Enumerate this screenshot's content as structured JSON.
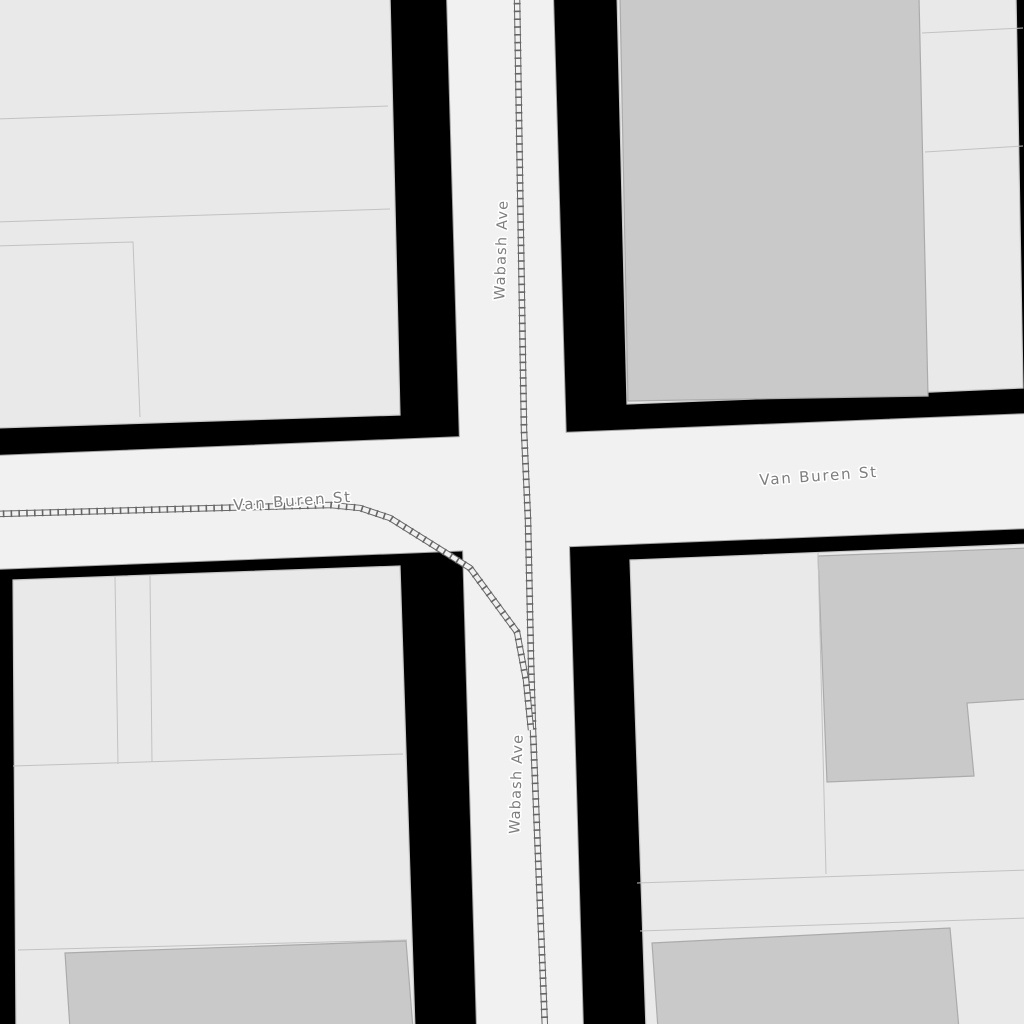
{
  "map": {
    "width": 1024,
    "height": 1024,
    "colors": {
      "background": "#000000",
      "road_fill": "#f1f1f1",
      "road_casing": "#a3a3a3",
      "light_building_fill": "#e9e9e9",
      "light_building_stroke": "#c6c6c6",
      "dark_building_fill": "#c9c9c9",
      "dark_building_stroke": "#ababab",
      "building_line": "#c2c2c2",
      "railway": "#666666",
      "label_fill": "#7e7e7e",
      "label_halo": "#ffffff"
    },
    "roads": [
      {
        "name": "Wabash Ave",
        "points": [
          [
            447,
            -5
          ],
          [
            553,
            -5
          ],
          [
            583,
            1029
          ],
          [
            477,
            1029
          ]
        ]
      },
      {
        "name": "Van Buren St",
        "points": [
          [
            -5,
            456
          ],
          [
            1029,
            414
          ],
          [
            1029,
            528
          ],
          [
            -5,
            569
          ]
        ]
      }
    ],
    "buildings": [
      {
        "shade": "light",
        "block": "northwest",
        "points": [
          [
            -5,
            -5
          ],
          [
            390,
            -5
          ],
          [
            400,
            415
          ],
          [
            -5,
            428
          ]
        ]
      },
      {
        "shade": "light",
        "block": "northeast",
        "points": [
          [
            617,
            -5
          ],
          [
            1016,
            -5
          ],
          [
            1023,
            388
          ],
          [
            932,
            392
          ],
          [
            627,
            404
          ]
        ]
      },
      {
        "shade": "dark",
        "block": "northeast",
        "points": [
          [
            620,
            -3
          ],
          [
            919,
            -3
          ],
          [
            928,
            396
          ],
          [
            628,
            401
          ]
        ]
      },
      {
        "shade": "light",
        "block": "southwest",
        "points": [
          [
            13,
            580
          ],
          [
            400,
            566
          ],
          [
            415,
            1029
          ],
          [
            16,
            1029
          ]
        ]
      },
      {
        "shade": "dark",
        "block": "southwest",
        "points": [
          [
            65,
            953
          ],
          [
            406,
            941
          ],
          [
            413,
            1029
          ],
          [
            70,
            1029
          ]
        ]
      },
      {
        "shade": "light",
        "block": "southeast",
        "points": [
          [
            630,
            560
          ],
          [
            1029,
            544
          ],
          [
            1029,
            1029
          ],
          [
            646,
            1029
          ]
        ]
      },
      {
        "shade": "dark",
        "block": "southeast",
        "points": [
          [
            818,
            556
          ],
          [
            1029,
            548
          ],
          [
            1029,
            699
          ],
          [
            967,
            703
          ],
          [
            974,
            776
          ],
          [
            827,
            782
          ]
        ]
      },
      {
        "shade": "dark",
        "block": "southeast-bottom",
        "points": [
          [
            652,
            943
          ],
          [
            950,
            928
          ],
          [
            959,
            1029
          ],
          [
            658,
            1029
          ]
        ]
      }
    ],
    "building_detail_lines": [
      {
        "points": [
          [
            -5,
            119
          ],
          [
            388,
            106
          ]
        ]
      },
      {
        "points": [
          [
            -5,
            222
          ],
          [
            390,
            209
          ]
        ]
      },
      {
        "points": [
          [
            -5,
            246
          ],
          [
            133,
            242
          ],
          [
            140,
            417
          ]
        ]
      },
      {
        "points": [
          [
            922,
            33
          ],
          [
            1023,
            28
          ]
        ]
      },
      {
        "points": [
          [
            925,
            152
          ],
          [
            1023,
            146
          ]
        ]
      },
      {
        "points": [
          [
            115,
            577
          ],
          [
            118,
            764
          ]
        ]
      },
      {
        "points": [
          [
            150,
            576
          ],
          [
            152,
            762
          ]
        ]
      },
      {
        "points": [
          [
            13,
            766
          ],
          [
            403,
            754
          ]
        ]
      },
      {
        "points": [
          [
            18,
            950
          ],
          [
            407,
            940
          ]
        ]
      },
      {
        "points": [
          [
            818,
            553
          ],
          [
            826,
            874
          ]
        ]
      },
      {
        "points": [
          [
            637,
            883
          ],
          [
            1029,
            870
          ]
        ]
      },
      {
        "points": [
          [
            640,
            931
          ],
          [
            1029,
            918
          ]
        ]
      }
    ],
    "railways": [
      {
        "name": "loop-track-wabash-through",
        "points": [
          [
            517,
            -5
          ],
          [
            524,
            430
          ],
          [
            528,
            520
          ],
          [
            531,
            660
          ],
          [
            533,
            730
          ],
          [
            539,
            880
          ],
          [
            545,
            1029
          ]
        ]
      },
      {
        "name": "loop-track-van-buren-curve",
        "points": [
          [
            -5,
            514
          ],
          [
            255,
            507
          ],
          [
            330,
            505
          ],
          [
            360,
            508
          ],
          [
            390,
            518
          ],
          [
            470,
            568
          ],
          [
            517,
            632
          ],
          [
            526,
            680
          ],
          [
            531,
            730
          ]
        ]
      }
    ],
    "labels": [
      {
        "text": "Wabash Ave",
        "x": 506,
        "y": 250,
        "rotate": -88,
        "size": 14.5,
        "letter_spacing": 1.2
      },
      {
        "text": "Wabash Ave",
        "x": 521,
        "y": 784,
        "rotate": -88,
        "size": 14.5,
        "letter_spacing": 1.2
      },
      {
        "text": "Van Buren St",
        "x": 293,
        "y": 506,
        "rotate": -4,
        "size": 15,
        "letter_spacing": 1.8
      },
      {
        "text": "Van Buren St",
        "x": 819,
        "y": 481,
        "rotate": -4,
        "size": 15,
        "letter_spacing": 1.8
      }
    ]
  }
}
